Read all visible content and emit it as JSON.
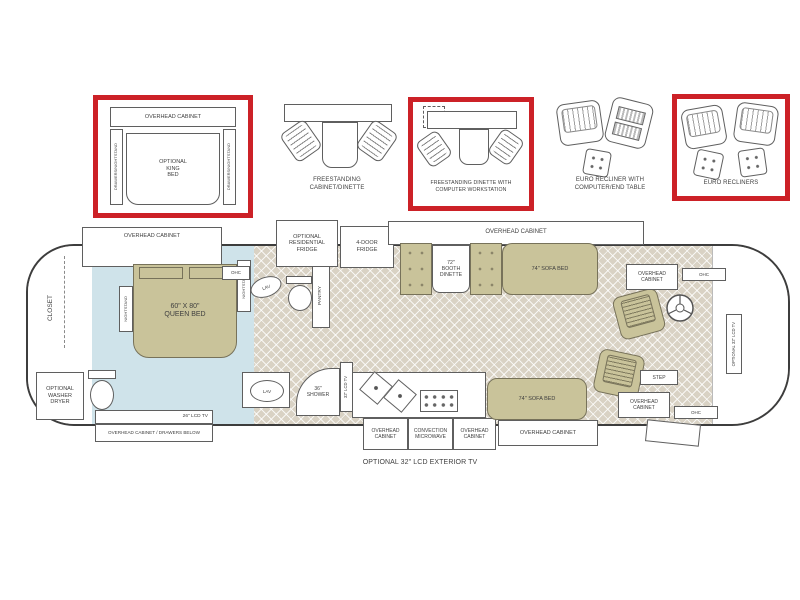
{
  "colors": {
    "highlight_red": "#cc2127",
    "furniture_tan": "#c9c39a",
    "floor_beige": "#d9d2c4",
    "bedroom_blue": "#cfe3ea",
    "line_gray": "#5f5f5f"
  },
  "options": {
    "king_bed": {
      "highlighted": true,
      "overhead_cabinet": "OVERHEAD CABINET",
      "drawers_nightstand": "DRAWERS/NIGHTSTAND",
      "bed": "OPTIONAL\nKING\nBED"
    },
    "freestanding_cabinet_dinette": {
      "highlighted": false,
      "label": "FREESTANDING\nCABINET/DINETTE"
    },
    "freestanding_dinette_workstation": {
      "highlighted": true,
      "label": "FREESTANDING DINETTE WITH\nCOMPUTER WORKSTATION"
    },
    "euro_recliner_table": {
      "highlighted": false,
      "label": "EURO RECLINER WITH\nCOMPUTER/END TABLE"
    },
    "euro_recliners": {
      "highlighted": true,
      "label": "EURO RECLINERS"
    }
  },
  "floorplan": {
    "bedroom_slide_overhead": "OVERHEAD CABINET",
    "closet": "CLOSET",
    "optional_washer_dryer": "OPTIONAL\nWASHER\nDRYER",
    "queen_bed": "60\" X 80\"\nQUEEN BED",
    "nightstand": "NIGHTSTAND",
    "ohc": "OHC",
    "lav": "LAV",
    "pantry": "PANTRY",
    "optional_residential_fridge": "OPTIONAL\nRESIDENTIAL\nFRIDGE",
    "four_door_fridge": "4-DOOR\nFRIDGE",
    "galley_slide_overhead": "OVERHEAD CABINET",
    "booth_dinette": "72\"\nBOOTH\nDINETTE",
    "sofa_bed": "74\" SOFA BED",
    "shower": "36\"\nSHOWER",
    "tv_32_bath": "32\" LCD TV",
    "tv_26": "26\" LCD TV",
    "overhead_cabinet_drawers_below": "OVERHEAD CABINET / DRAWERS BELOW",
    "overhead_cabinet_2line": "OVERHEAD\nCABINET",
    "convection_microwave": "CONVECTION\nMICROWAVE",
    "overhead_cabinet": "OVERHEAD CABINET",
    "step": "STEP",
    "optional_tv_32": "OPTIONAL 32\" LCD TV",
    "optional_exterior_tv": "OPTIONAL 32\" LCD EXTERIOR TV"
  }
}
